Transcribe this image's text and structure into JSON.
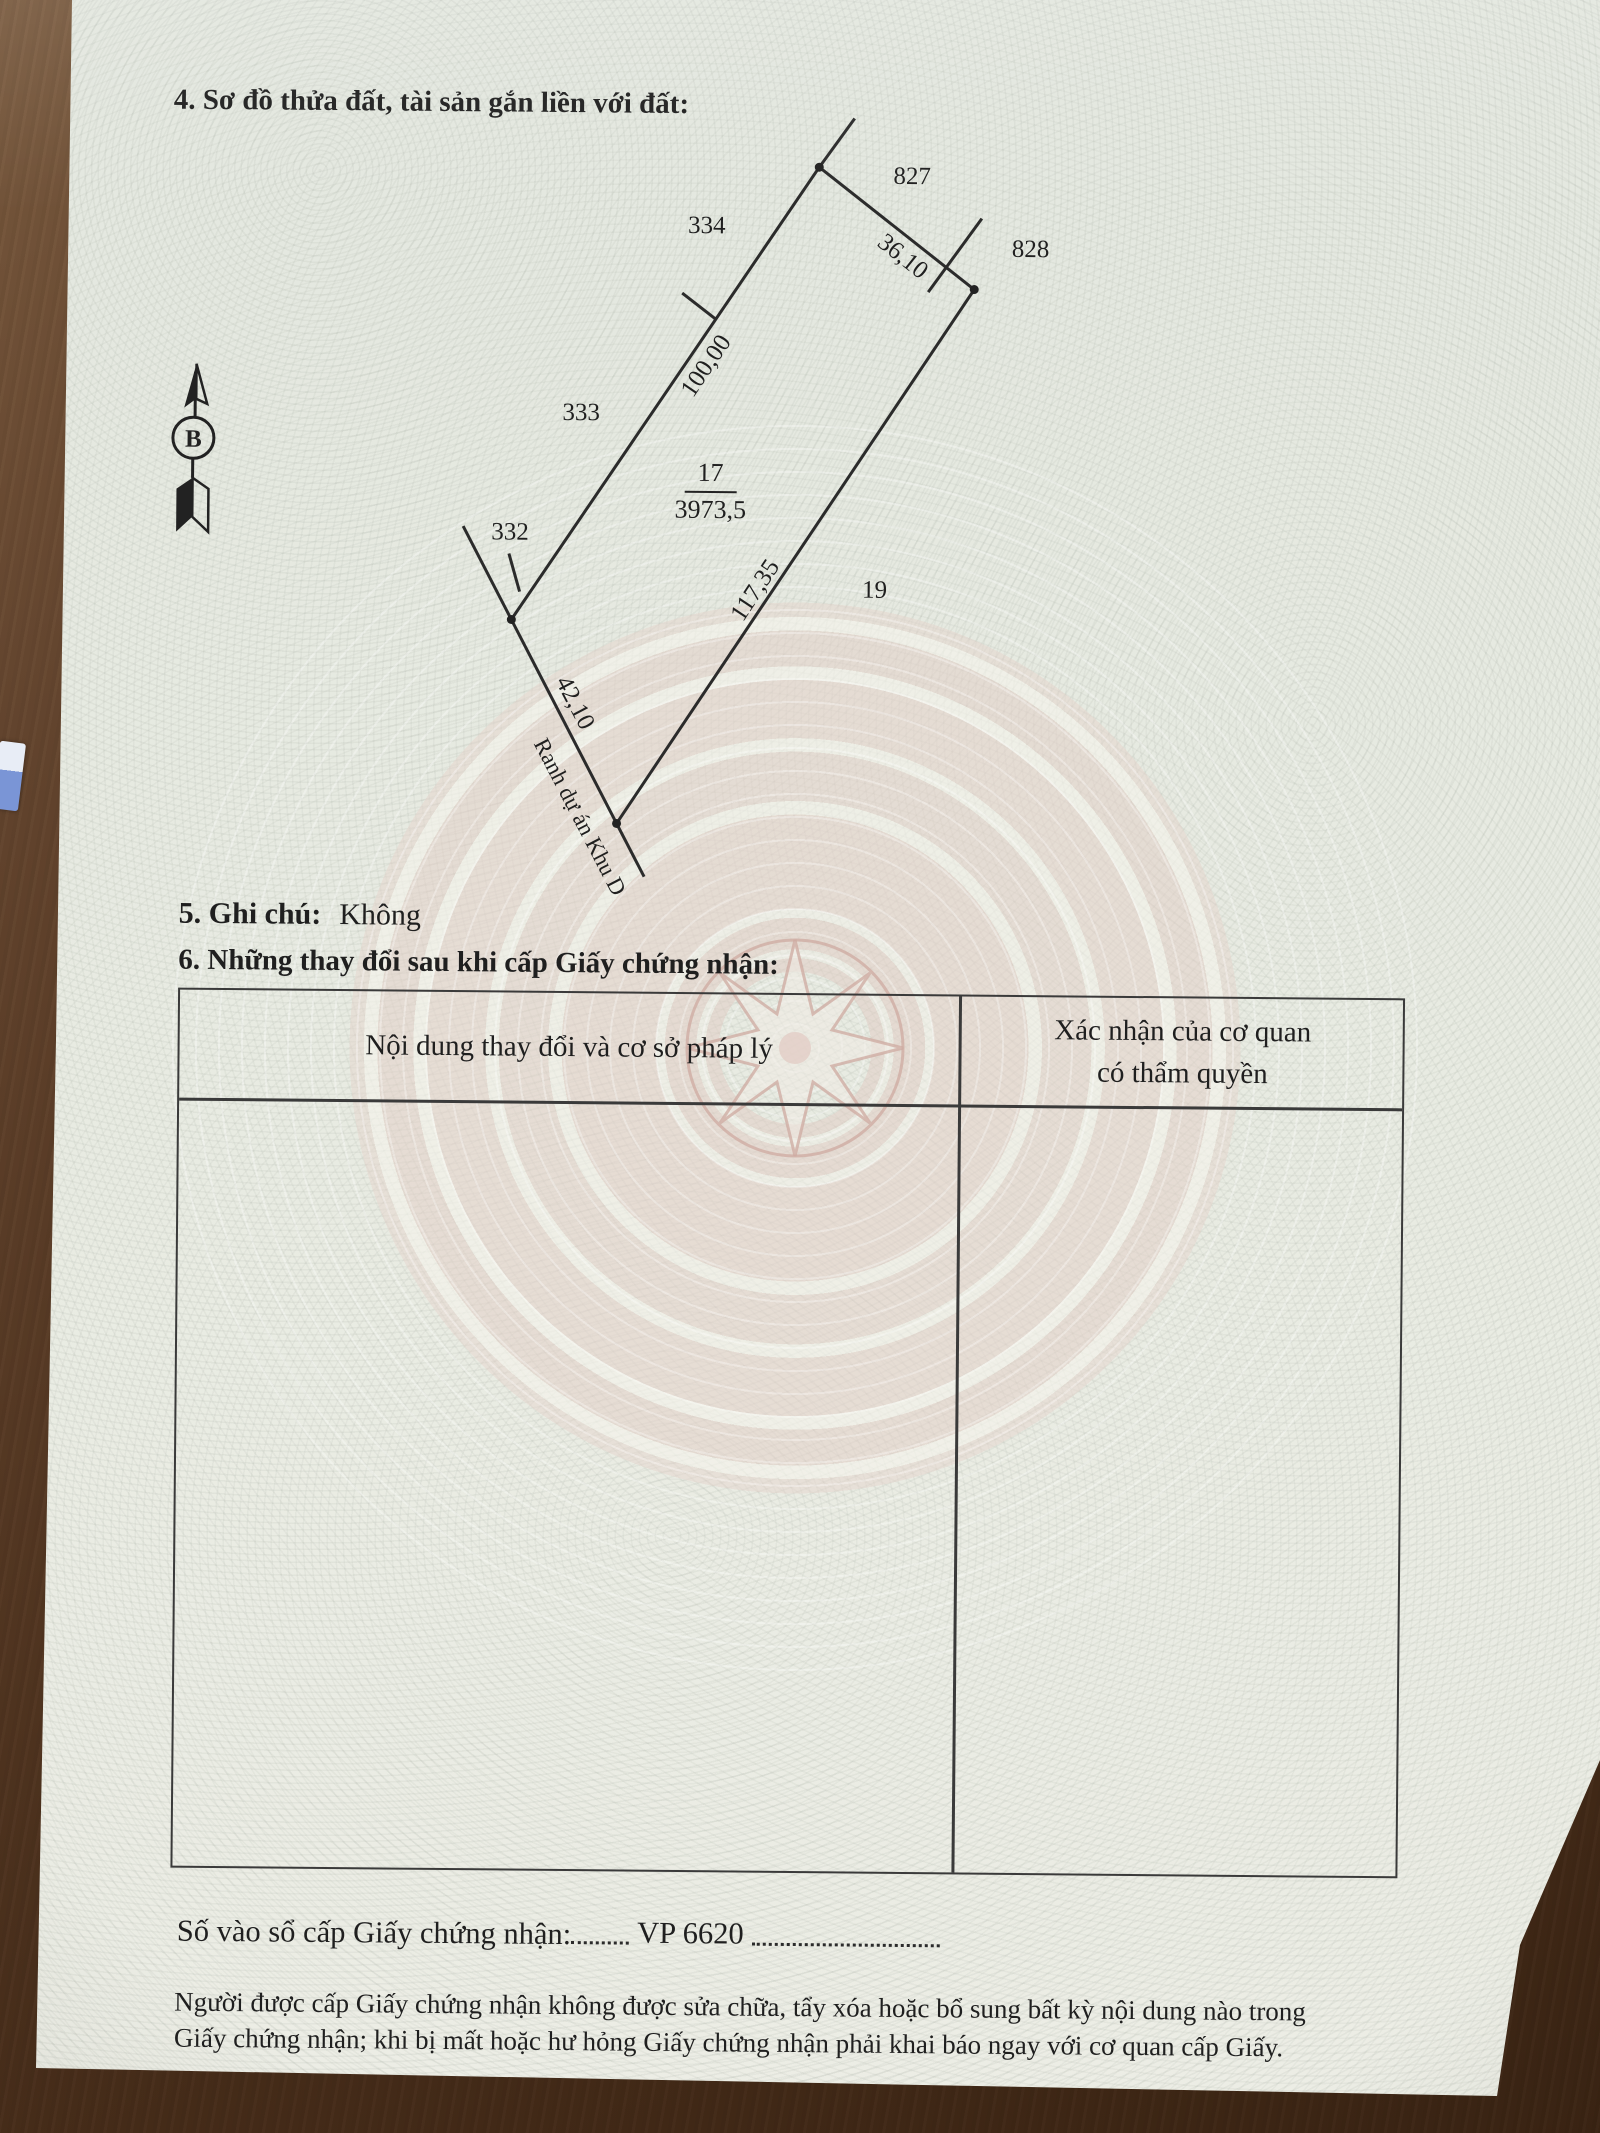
{
  "document": {
    "section4": {
      "title": "4. Sơ đồ thửa đất, tài sản gắn liền với đất:"
    },
    "section5": {
      "label": "5. Ghi chú:",
      "value": "Không"
    },
    "section6": {
      "title": "6. Những thay đổi sau khi cấp Giấy chứng nhận:",
      "table": {
        "col1_header": "Nội dung thay đổi và cơ sở pháp lý",
        "col2_header_line1": "Xác nhận của cơ quan",
        "col2_header_line2": "có thẩm quyền"
      }
    },
    "serial": {
      "label": "Số vào sổ cấp Giấy chứng nhận:",
      "value": "VP 6620"
    },
    "footer": {
      "line1": "Người được cấp Giấy chứng nhận không được sửa chữa, tẩy xóa hoặc bổ sung bất kỳ nội dung nào trong",
      "line2": "Giấy chứng nhận; khi bị mất hoặc hư hỏng Giấy chứng nhận phải khai báo ngay với cơ quan cấp Giấy."
    }
  },
  "diagram": {
    "north_label": "B",
    "parcel": {
      "number": "17",
      "area": "3973,5"
    },
    "neighbors": {
      "n827": "827",
      "n828": "828",
      "n334": "334",
      "n333": "333",
      "n332": "332",
      "n19": "19"
    },
    "lengths": {
      "top": "36,10",
      "left": "100,00",
      "right": "117,35",
      "bottom": "42,10"
    },
    "boundary_note": "Ranh dự án Khu D"
  },
  "colors": {
    "paper": "#e8ebe2",
    "wood": "#553823",
    "motif_pink": "#e2cfc8",
    "ink": "#1f1f1f"
  }
}
